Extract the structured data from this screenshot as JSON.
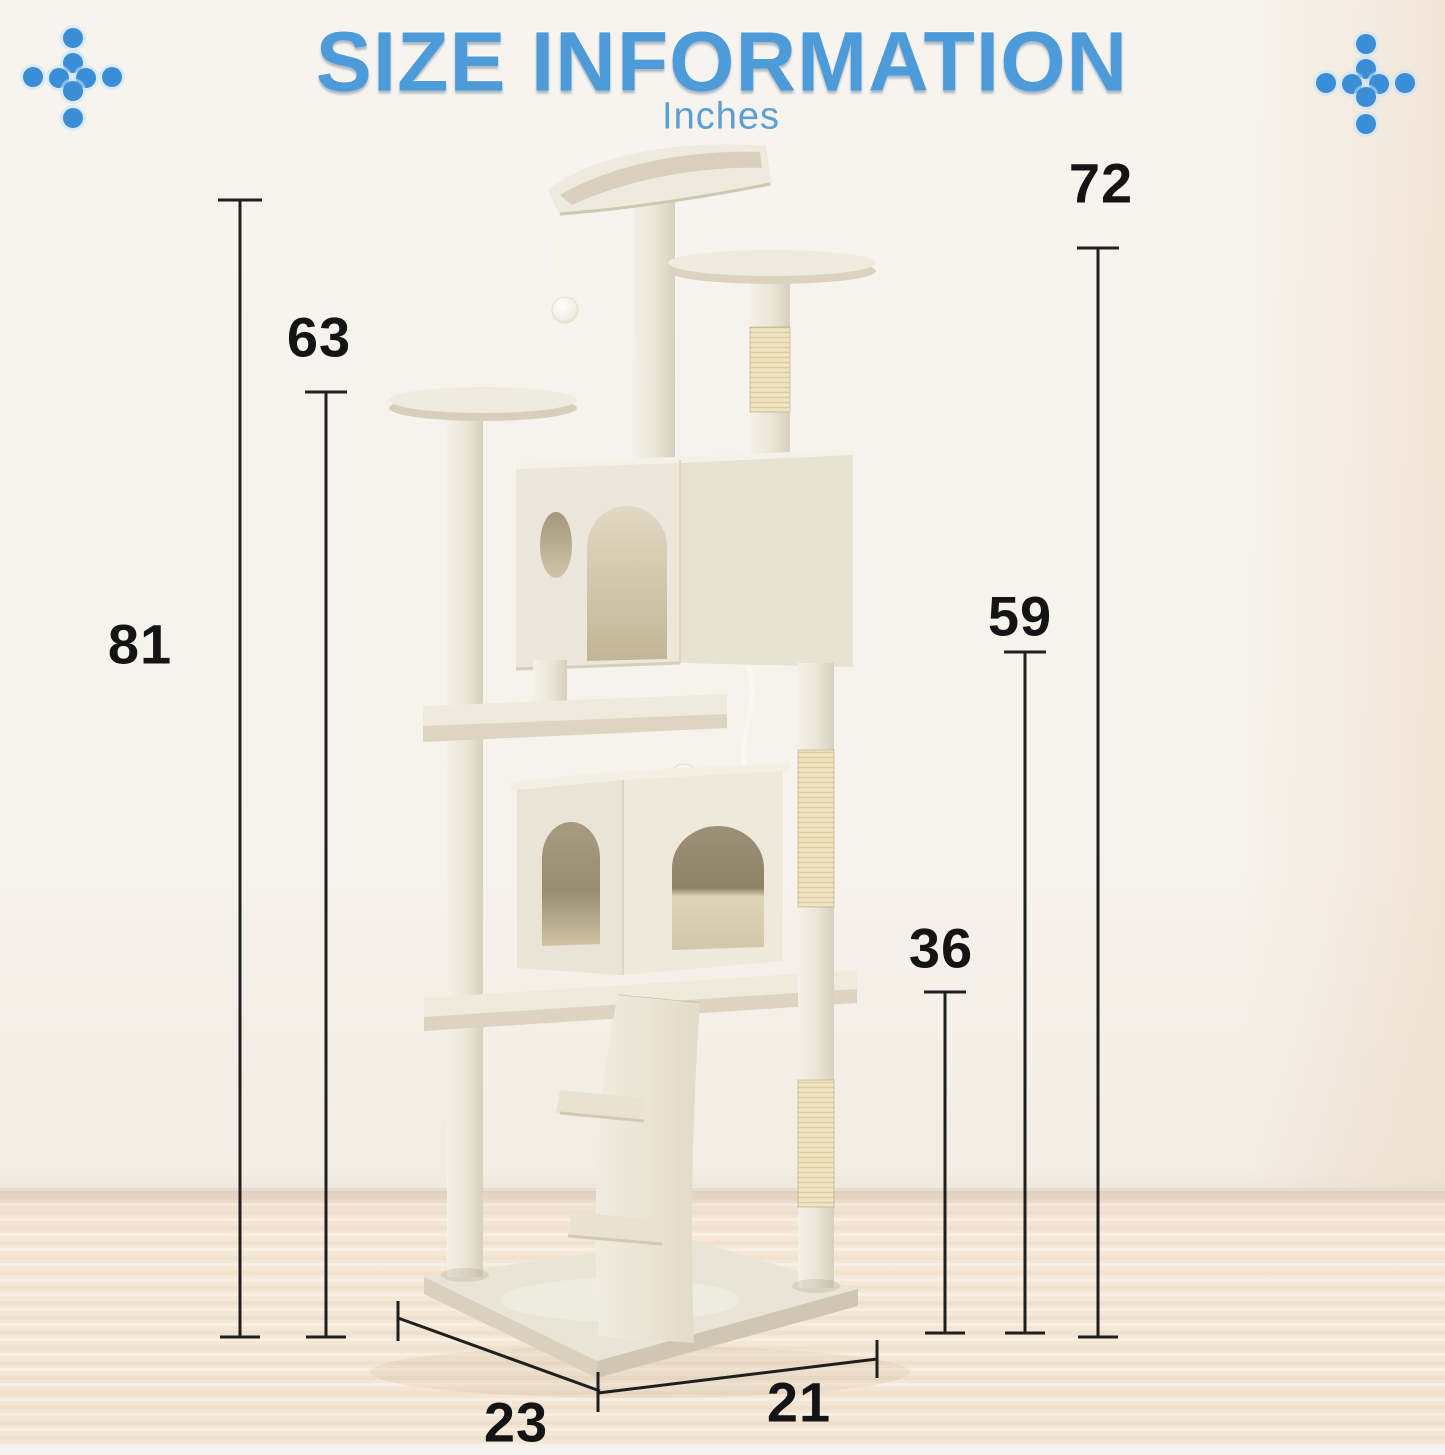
{
  "header": {
    "title": "SIZE INFORMATION",
    "subtitle": "Inches",
    "title_color": "#4d9bd9"
  },
  "decor": {
    "dot_color": "#3a8ed8",
    "pattern": "plus-dot-cross"
  },
  "scene": {
    "wall_color": "#f6f2ed",
    "floor_color": "#f5e7d6",
    "dimension_line_color": "#1f1f1f"
  },
  "product": {
    "label": "cat-tree-tower",
    "plush_color": "#ece7da",
    "sisal_color": "#efe5c4"
  },
  "measurements": {
    "unit": "Inches",
    "total_height": "81",
    "left_perch_height": "63",
    "right_post_height": "72",
    "upper_platform_height": "59",
    "lower_platform_height": "36",
    "base_depth": "23",
    "base_width": "21"
  }
}
